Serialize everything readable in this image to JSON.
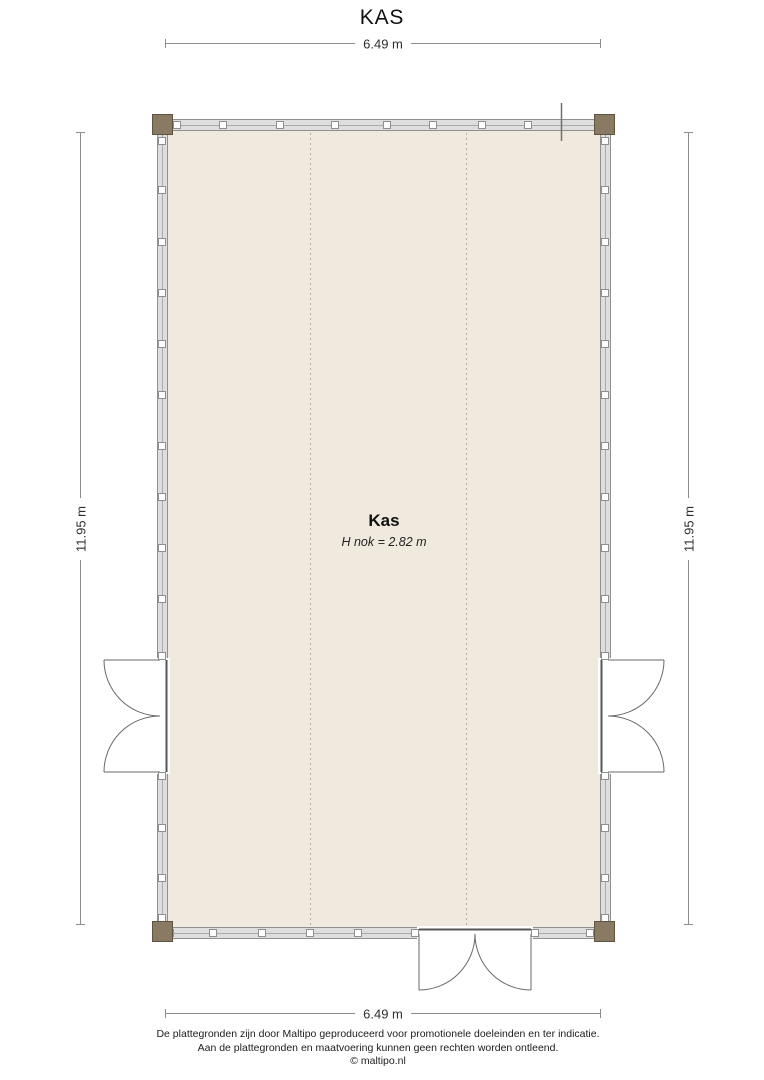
{
  "title": "KAS",
  "dimensions": {
    "top": "6.49 m",
    "bottom": "6.49 m",
    "left": "11.95 m",
    "right": "11.95 m"
  },
  "room": {
    "name": "Kas",
    "height_note": "H nok = 2.82 m"
  },
  "footer": {
    "line1": "De plattegronden zijn door Maltipo geproduceerd voor promotionele doeleinden en ter indicatie.",
    "line2": "Aan de plattegronden en maatvoering kunnen geen rechten worden ontleend.",
    "line3": "© maltipo.nl"
  },
  "colors": {
    "floor": "#f0e9de",
    "wall_fill": "#dedede",
    "wall_border": "#8f8f8f",
    "post": "#8a7a64",
    "door_line": "#6a6a6a",
    "dim_line": "#8c8c8c"
  }
}
